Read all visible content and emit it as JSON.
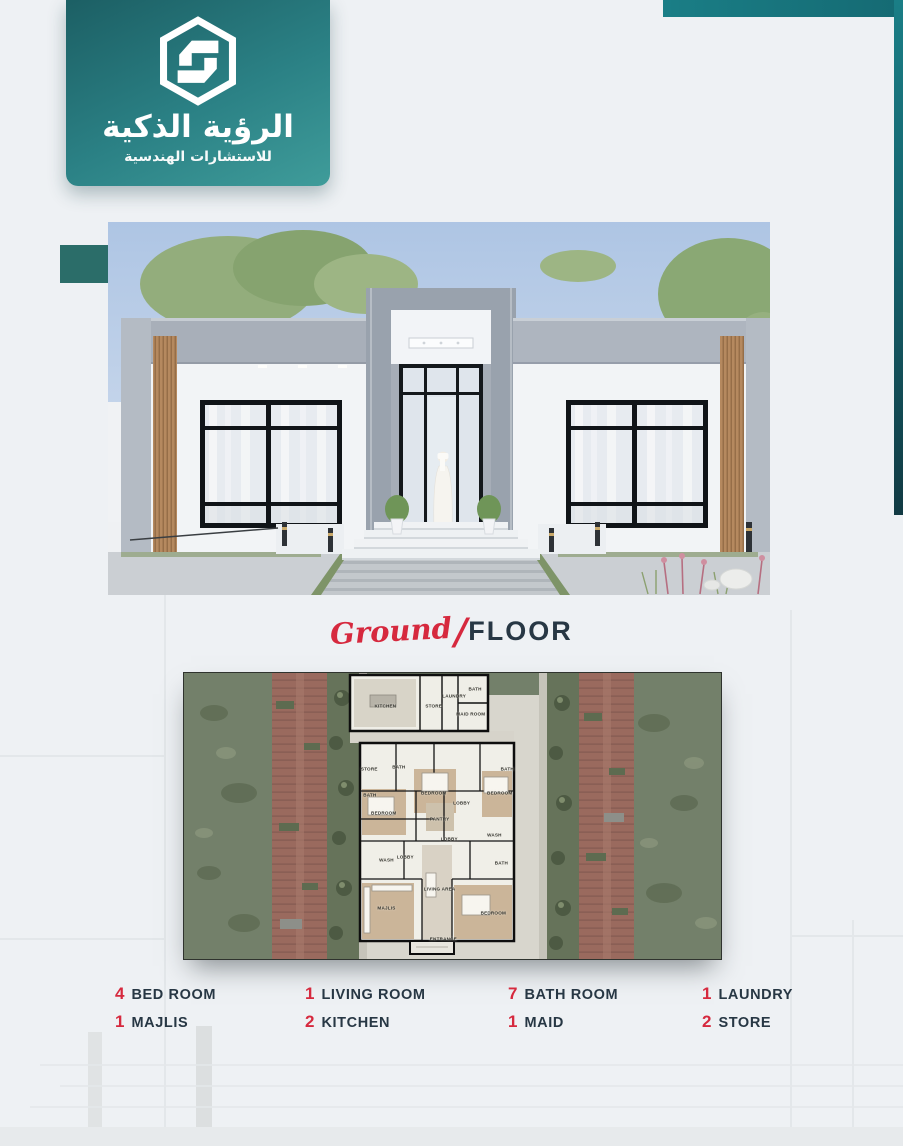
{
  "brand": {
    "logo_icon": "hexagon-s-logo-icon",
    "name_ar": "الرؤية الذكية",
    "tagline_ar": "للاستشارات الهندسية",
    "badge_gradient_top": "#1c5f64",
    "badge_gradient_bottom": "#3f9c9a"
  },
  "decor": {
    "teal_bar": "#1a7e86",
    "teal_strip_bottom": "#113a43",
    "teal_square": "#2b6d69"
  },
  "section_title": {
    "script": "Ground",
    "slash": "/",
    "main": "FLOOR",
    "script_color": "#d6293e",
    "main_color": "#273744"
  },
  "floor_plan": {
    "rooms": [
      {
        "label": "KITCHEN",
        "x": 37.5,
        "y": 11.5
      },
      {
        "label": "STORE",
        "x": 46.5,
        "y": 11.5
      },
      {
        "label": "LAUNDRY",
        "x": 50.3,
        "y": 8.0
      },
      {
        "label": "BATH",
        "x": 54.2,
        "y": 5.5
      },
      {
        "label": "MAID ROOM",
        "x": 53.4,
        "y": 14.5
      },
      {
        "label": "STORE",
        "x": 34.5,
        "y": 33.5
      },
      {
        "label": "BATH",
        "x": 40.0,
        "y": 33.0
      },
      {
        "label": "BATH",
        "x": 34.6,
        "y": 42.5
      },
      {
        "label": "BEDROOM",
        "x": 46.5,
        "y": 42.0
      },
      {
        "label": "LOBBY",
        "x": 51.7,
        "y": 45.5
      },
      {
        "label": "BATH",
        "x": 60.2,
        "y": 33.5
      },
      {
        "label": "BEDROOM",
        "x": 58.8,
        "y": 42.0
      },
      {
        "label": "BEDROOM",
        "x": 37.2,
        "y": 49.0
      },
      {
        "label": "PANTRY",
        "x": 47.6,
        "y": 51.0
      },
      {
        "label": "LOBBY",
        "x": 49.4,
        "y": 58.0
      },
      {
        "label": "WASH",
        "x": 57.8,
        "y": 56.5
      },
      {
        "label": "WASH",
        "x": 37.7,
        "y": 65.5
      },
      {
        "label": "LOBBY",
        "x": 41.2,
        "y": 64.5
      },
      {
        "label": "LIVING AREA",
        "x": 47.6,
        "y": 75.5
      },
      {
        "label": "BATH",
        "x": 59.1,
        "y": 66.5
      },
      {
        "label": "MAJLIS",
        "x": 37.7,
        "y": 82.0
      },
      {
        "label": "BEDROOM",
        "x": 57.6,
        "y": 84.0
      },
      {
        "label": "ENTRANCE",
        "x": 48.3,
        "y": 93.0
      }
    ]
  },
  "stats": {
    "number_color": "#d6293e",
    "label_color": "#273744",
    "items": [
      {
        "count": "4",
        "label": "BED ROOM"
      },
      {
        "count": "1",
        "label": "LIVING ROOM"
      },
      {
        "count": "7",
        "label": "BATH ROOM"
      },
      {
        "count": "1",
        "label": "LAUNDRY"
      },
      {
        "count": "1",
        "label": "MAJLIS"
      },
      {
        "count": "2",
        "label": "KITCHEN"
      },
      {
        "count": "1",
        "label": "MAID"
      },
      {
        "count": "2",
        "label": "STORE"
      }
    ]
  }
}
